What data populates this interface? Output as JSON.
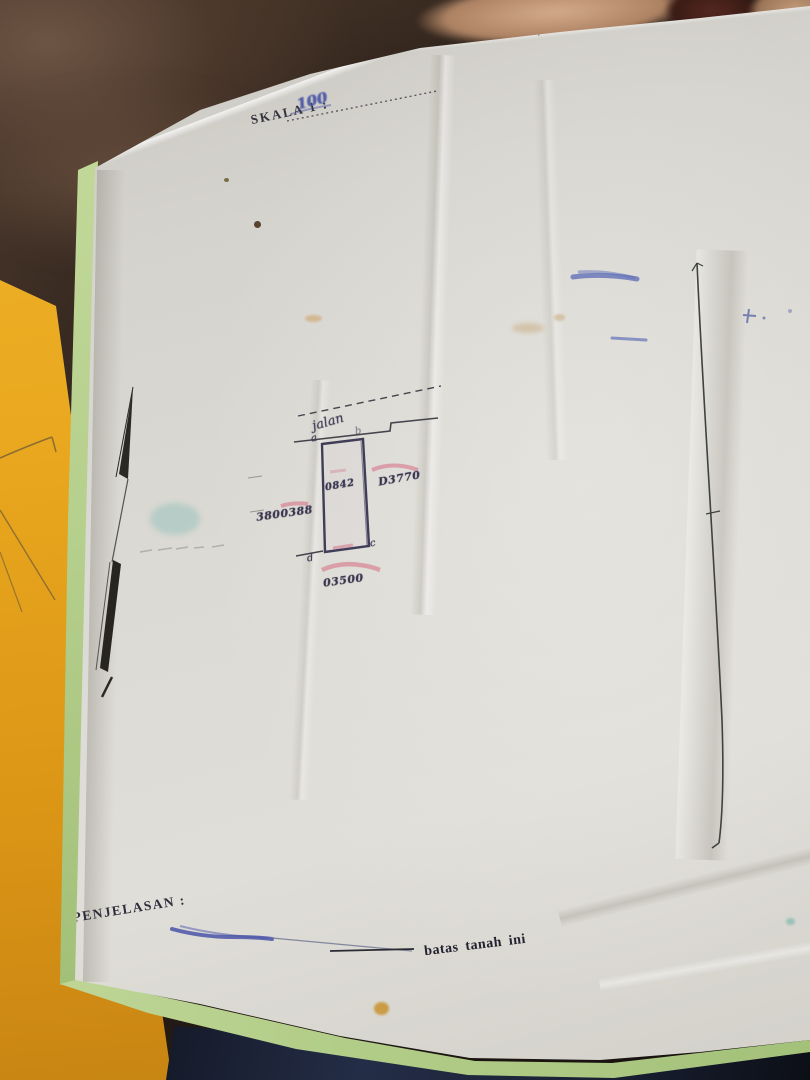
{
  "photo": {
    "scale": {
      "label": "SKALA 1 :",
      "value": "100"
    },
    "sketch": {
      "road_label": "jalan",
      "corners": {
        "a": "a",
        "b": "b",
        "c": "c",
        "d": "d"
      },
      "area_text": "0842",
      "left_number": "3800388",
      "right_number": "D3770",
      "bottom_number": "03500"
    },
    "legend": {
      "heading": "PENJELASAN :",
      "boundary_label": "batas tanah ini"
    },
    "colors": {
      "paper": "#dcdad4",
      "couch_brown": "#2a201a",
      "envelope_yellow": "#e9a81f",
      "folder_green": "#b5cf8c",
      "ink_blue": "#5560a8",
      "ink_dark": "#3f3c55",
      "highlight_red": "#d4607a",
      "shadow_navy": "#242d47"
    }
  }
}
